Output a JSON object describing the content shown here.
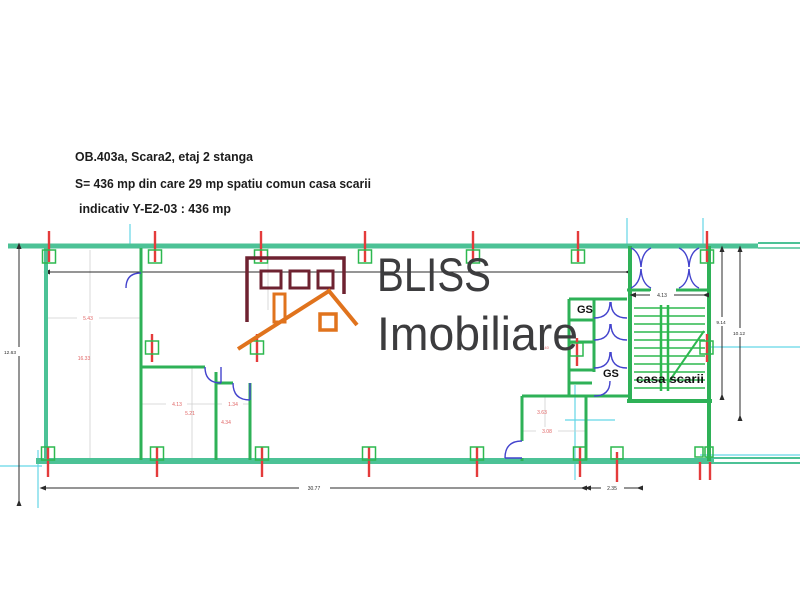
{
  "header": {
    "line1": "OB.403a, Scara2, etaj 2 stanga",
    "line2": "S= 436 mp din care 29 mp spatiu comun casa scarii",
    "line3": "indicativ Y-E2-03 : 436 mp"
  },
  "logo": {
    "name": "BLISS",
    "subname": "Imobiliare",
    "colors": {
      "building": "#6e2230",
      "roof": "#e0731d",
      "text": "#3c3c3e"
    }
  },
  "plan": {
    "labels": {
      "gs_upper": "GS",
      "gs_lower": "GS",
      "staircase": "casa scarii"
    },
    "dimensions": {
      "left_height": "12.63",
      "overall_width": "30.77",
      "right_offset": "2.35",
      "stair_width": "4.13",
      "stair_height": "9.14",
      "right_height": "10.12",
      "left_bay": "5.43",
      "left_room": "16.33",
      "storage_width": "4.13",
      "niche_width": "1.34",
      "storage_height": "5.21",
      "niche_height": "4.34",
      "room_width": "3.63",
      "room_height": "3.08",
      "gs_span": "5.40"
    },
    "colors": {
      "wall_outer": "#4cc296",
      "wall_inner": "#2eb157",
      "stairs": "#2db84f",
      "door": "#4343cd",
      "column": "#e43b3b",
      "column_marker": "#2db84f",
      "construction": "#63d6e6",
      "guide": "#cfcfcf",
      "dimension": "#2b2b2b",
      "dimension_accent": "#e06464"
    }
  }
}
